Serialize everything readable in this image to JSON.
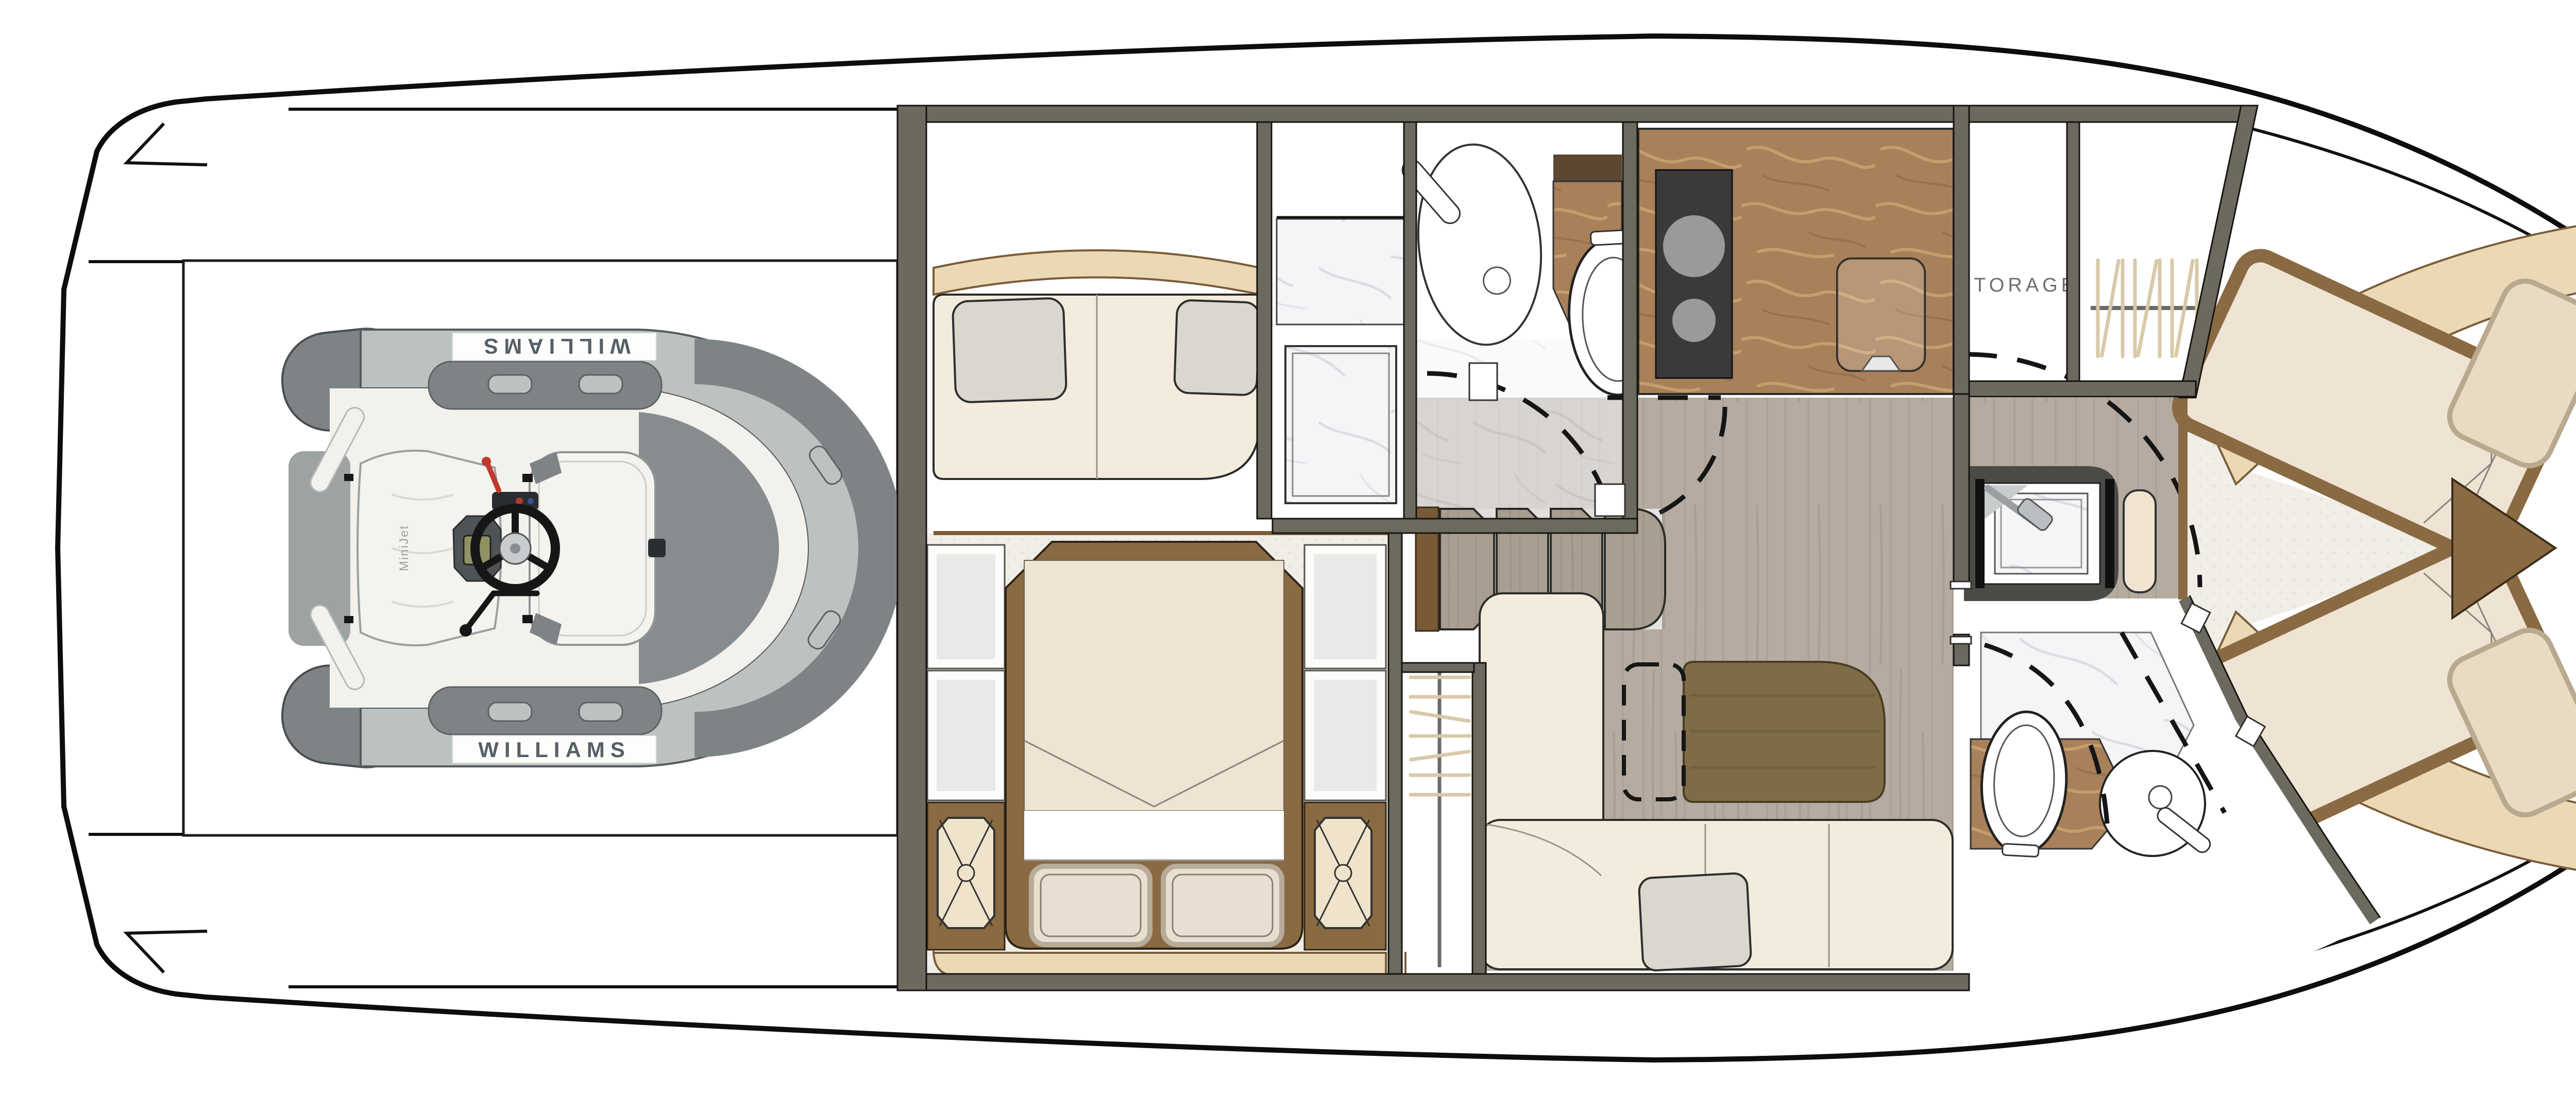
{
  "plan": {
    "type": "yacht-lower-deck-floor-plan",
    "labels": {
      "storage": "STORAGE",
      "tender_brand_top": "WILLIAMS",
      "tender_brand_bottom": "WILLIAMS",
      "tender_model": "MiniJet"
    },
    "colors": {
      "background": "#ffffff",
      "hull_outline": "#0d0d0d",
      "wall": "#6c6a5f",
      "wood_floor": "#b6aba0",
      "carpet": "#f0eee7",
      "upholstery_cream": "#f3ecdd",
      "cushion_tan": "#ead9b4",
      "trim_brown": "#8a6a42",
      "counter_brown_marble": "#a8805a",
      "marble_white": "#f5f5f7",
      "pillow_gray": "#dbd7ce",
      "table_wood": "#7e6c47",
      "tender_tube_gray": "#7e8486",
      "tender_hull_white": "#f2f1ec",
      "cooktop_black": "#3a3a3a"
    }
  }
}
